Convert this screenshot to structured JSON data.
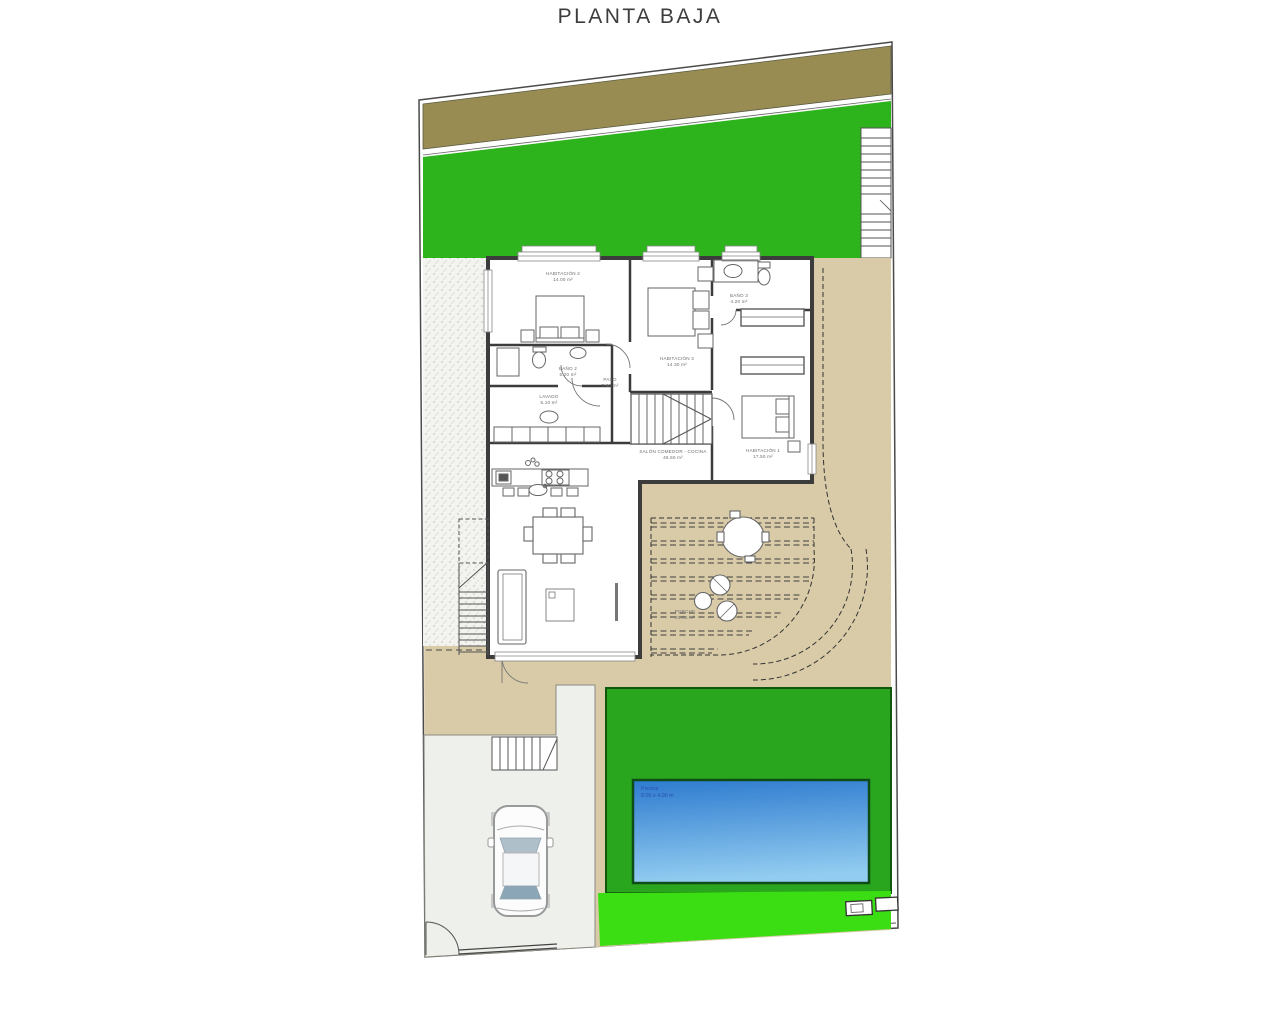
{
  "title": "PLANTA BAJA",
  "plan": {
    "rooms": {
      "habitacion2": {
        "name": "HABITACIÓN 2",
        "area": "14.00 m²"
      },
      "habitacion3": {
        "name": "HABITACIÓN 3",
        "area": "14.30 m²"
      },
      "bano3": {
        "name": "BAÑO 3",
        "area": "4.20 m²"
      },
      "bano2": {
        "name": "BAÑO 2",
        "area": "5.20 m²"
      },
      "lavado": {
        "name": "LAVADO",
        "area": "5.10 m²"
      },
      "paso": {
        "name": "PASO",
        "area": "7.60 m²"
      },
      "salon": {
        "name": "SALÓN COMEDOR - COCINA",
        "area": "46.50 m²"
      },
      "habitacion1": {
        "name": "HABITACIÓN 1",
        "area": "17.50 m²"
      },
      "porche": {
        "name": "PORCHE",
        "area": "23.85 m²"
      }
    },
    "pool": {
      "name": "Piscina",
      "size": "8.00 x 4.00 m"
    }
  },
  "colors": {
    "street_band": "#988c53",
    "lawn_top": "#2db31c",
    "lawn_pool": "#2aa61e",
    "lawn_bottom_strip": "#3ade12",
    "terrace": "#d9cba7",
    "driveway": "#eef0ec",
    "pool_water_top": "#2e7bcf",
    "pool_water_bottom": "#92ccf0",
    "walls": "#3c3c3c"
  }
}
